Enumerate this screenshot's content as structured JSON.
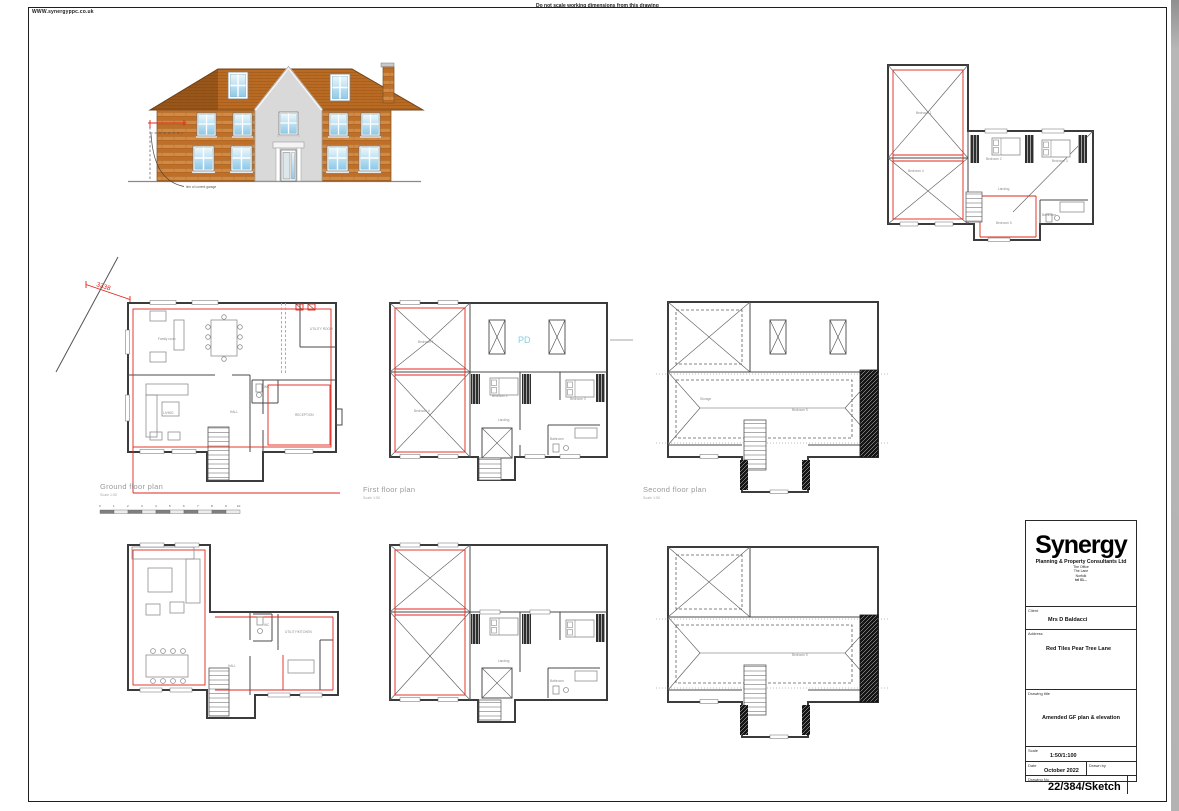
{
  "page": {
    "website": "WWW.synergyppc.co.uk",
    "note": "Do not scale working dimensions from this drawing"
  },
  "annotations": {
    "dimension": "3338",
    "garage_note": "line of current garage"
  },
  "scale_bar": {
    "ticks": [
      "0",
      "1",
      "2",
      "3",
      "4",
      "5",
      "6",
      "7",
      "8",
      "9",
      "10"
    ]
  },
  "plans": {
    "ground": {
      "title": "Ground floor plan",
      "scale": "Scale 1:50",
      "rooms": {
        "family": "Family room",
        "living": "LIVING",
        "hall": "HALL",
        "reception": "RECEPTION",
        "utility": "UTILITY ROOM",
        "wc": "WC"
      }
    },
    "first": {
      "title": "First floor plan",
      "scale": "Scale 1:50",
      "pd": "PD",
      "rooms": {
        "bedroom1": "Bedroom 1",
        "bedroom4": "Bedroom 4",
        "bedroom2": "Bedroom 2",
        "bedroom3": "Bedroom 3",
        "landing": "Landing",
        "bathroom": "Bathroom"
      }
    },
    "second": {
      "title": "Second floor plan",
      "scale": "Scale 1:50",
      "rooms": {
        "storage": "Storage",
        "bedroom5": "Bedroom 5"
      }
    },
    "proposed_first": {
      "rooms": {
        "bedroom1": "Bedroom 1",
        "bedroom4": "Bedroom 4",
        "bedroom2": "Bedroom 2",
        "bedroom3": "Bedroom 3",
        "landing": "Landing",
        "bedroom5": "Bedroom 5",
        "bathroom": "Bathroom"
      }
    },
    "proposed_ground": {
      "rooms": {
        "hall": "HALL",
        "wc": "WC",
        "utility": "UTILITY/KITCHEN"
      }
    }
  },
  "title_block": {
    "brand": "Synergy",
    "brand_sub": "Planning & Property Consultants Ltd",
    "office_lines": [
      "The Office",
      "The Lane",
      "Norfolk",
      "tel 01..."
    ],
    "client_label": "Client",
    "client": "Mrs D Baldacci",
    "address_label": "Address",
    "address": "Red Tiles Pear Tree Lane",
    "drawing_title_label": "Drawing title",
    "drawing_title": "Amended GF plan & elevation",
    "scale_label": "Scale",
    "scale": "1:50/1:100",
    "date_label": "Date",
    "date": "October 2022",
    "drawn_by_label": "Drawn by",
    "drawing_no_label": "Drawing No",
    "drawing_no": "22/384/Sketch"
  },
  "colors": {
    "accent_red": "#e1251b",
    "magenta": "#ee6cf2",
    "cyan": "#7ed3e2",
    "brick": "#c97b35",
    "roof": "#bc6e27",
    "render_grey": "#d9d9d9"
  }
}
